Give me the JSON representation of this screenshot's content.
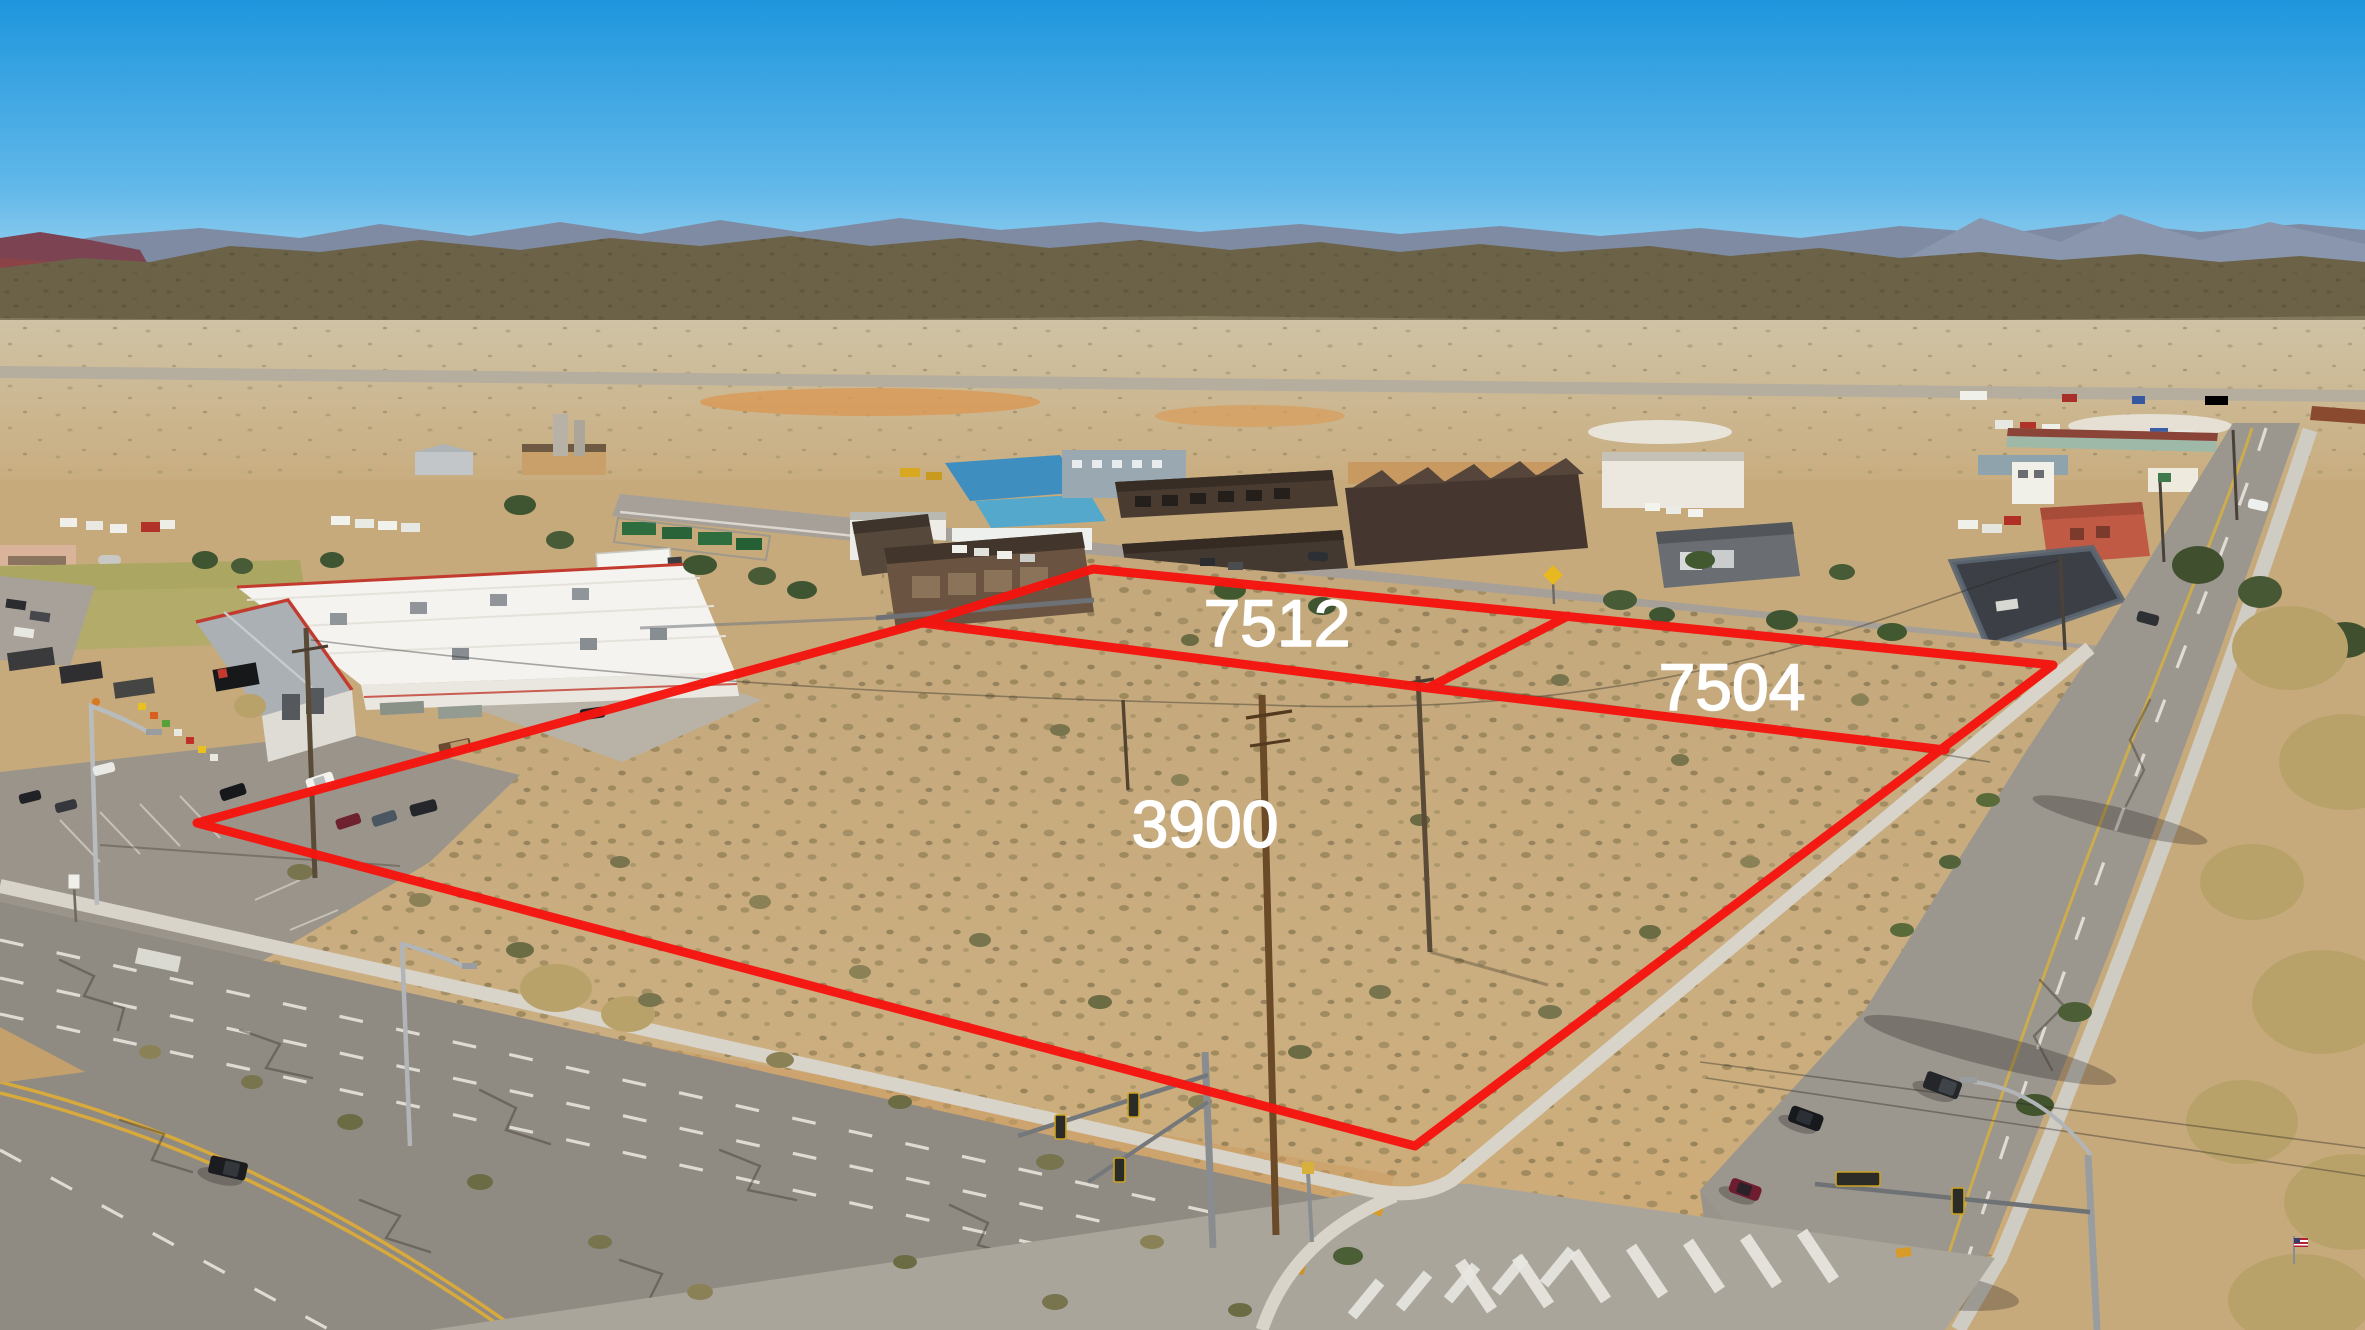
{
  "image": {
    "kind": "aerial-drone-photo"
  },
  "parcels": [
    {
      "label": "7512"
    },
    {
      "label": "7504"
    },
    {
      "label": "3900"
    }
  ],
  "annotation": {
    "boundary_color": "#f5150f",
    "label_color": "#ffffff"
  },
  "palette": {
    "sky_top": "#1e96dd",
    "sky_horizon": "#d6ecf7",
    "mountain": "#6b6248",
    "distant_mountain": "#7e8ba3",
    "red_hills": "#7c4452",
    "desert": "#c9ac7e",
    "road": "#98938b",
    "sidewalk": "#d8d4ca"
  }
}
